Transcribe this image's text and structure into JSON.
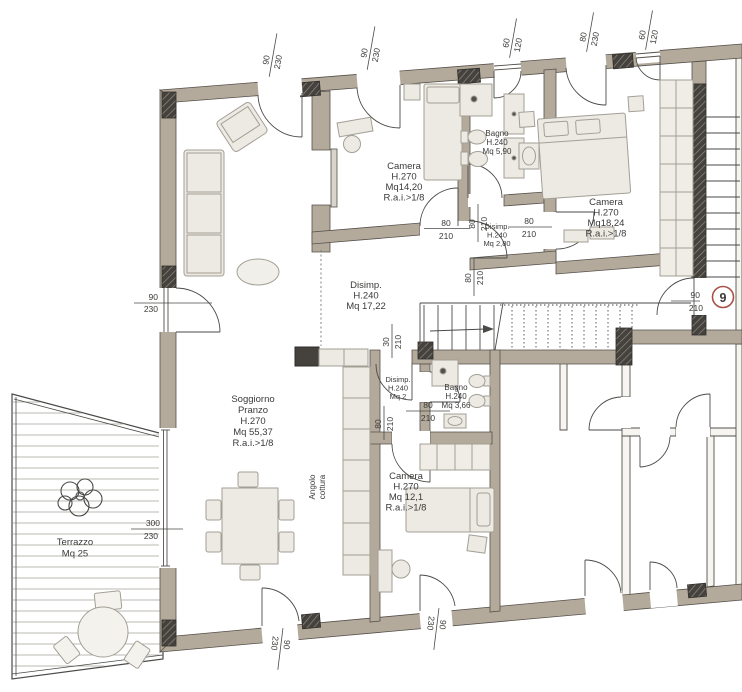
{
  "meta": {
    "drawing_type": "residential floor plan",
    "language": "it"
  },
  "colors": {
    "wall_fill": "#b4aa9c",
    "wall_stroke": "#55504a",
    "column_dark": "#45423e",
    "line": "#4a4a48",
    "text": "#3b3a38",
    "accent_badge": "#a85045",
    "furniture_fill": "#eceae3",
    "furniture_stroke": "#a39f96",
    "deck_line": "#bdb9b1"
  },
  "rooms": [
    {
      "id": "camera-nw",
      "lines": [
        "Camera",
        "H.270",
        "Mq14,20",
        "R.a.i.>1/8"
      ]
    },
    {
      "id": "bagno-nord",
      "lines": [
        "Bagno",
        "H.240",
        "Mq 5,90"
      ]
    },
    {
      "id": "camera-ne",
      "lines": [
        "Camera",
        "H.270",
        "Mq18,24",
        "R.a.i.>1/8"
      ]
    },
    {
      "id": "disimp-nord",
      "lines": [
        "Disimp.",
        "H.240",
        "Mq 2,80"
      ]
    },
    {
      "id": "disimpegno",
      "lines": [
        "Disimp.",
        "H.240",
        "Mq 17,22"
      ]
    },
    {
      "id": "disimp-sud",
      "lines": [
        "Disimp.",
        "H.240",
        "Mq 2"
      ]
    },
    {
      "id": "bagno-sud",
      "lines": [
        "Bagno",
        "H.240",
        "Mq 3,66"
      ]
    },
    {
      "id": "camera-sud",
      "lines": [
        "Camera",
        "H.270",
        "Mq 12,1",
        "R.a.i.>1/8"
      ]
    },
    {
      "id": "soggiorno",
      "lines": [
        "Soggiorno",
        "Pranzo",
        "H.270",
        "Mq 55,37",
        "R.a.i.>1/8"
      ]
    },
    {
      "id": "angolo-cottura",
      "lines": [
        "Angolo",
        "cottura"
      ]
    },
    {
      "id": "terrazzo",
      "lines": [
        "Terrazzo",
        "Mq 25"
      ]
    }
  ],
  "dims": [
    {
      "id": "win-nw-1",
      "values": [
        "90",
        "230"
      ]
    },
    {
      "id": "win-nw-2",
      "values": [
        "90",
        "230"
      ]
    },
    {
      "id": "win-bagno-n",
      "values": [
        "60",
        "120"
      ]
    },
    {
      "id": "win-ne",
      "values": [
        "80",
        "230"
      ]
    },
    {
      "id": "win-ne-small",
      "values": [
        "60",
        "120"
      ]
    },
    {
      "id": "door-west",
      "values": [
        "90",
        "230"
      ]
    },
    {
      "id": "door-camera-nw",
      "values": [
        "80",
        "210"
      ]
    },
    {
      "id": "door-bagno-n",
      "values": [
        "80",
        "210"
      ]
    },
    {
      "id": "door-disimp-n",
      "values": [
        "80",
        "210"
      ]
    },
    {
      "id": "door-camera-ne",
      "values": [
        "80",
        "210"
      ]
    },
    {
      "id": "pass-corridoio",
      "values": [
        "30",
        "210"
      ]
    },
    {
      "id": "door-disimp-s",
      "values": [
        "80",
        "210"
      ]
    },
    {
      "id": "door-camera-s",
      "values": [
        "80",
        "210"
      ]
    },
    {
      "id": "door-entry",
      "values": [
        "90",
        "210"
      ]
    },
    {
      "id": "win-terrazza",
      "values": [
        "300",
        "230"
      ]
    },
    {
      "id": "door-sud-1",
      "values": [
        "90",
        "230"
      ]
    },
    {
      "id": "door-sud-2",
      "values": [
        "90",
        "230"
      ]
    }
  ],
  "badge": {
    "number": "9"
  }
}
